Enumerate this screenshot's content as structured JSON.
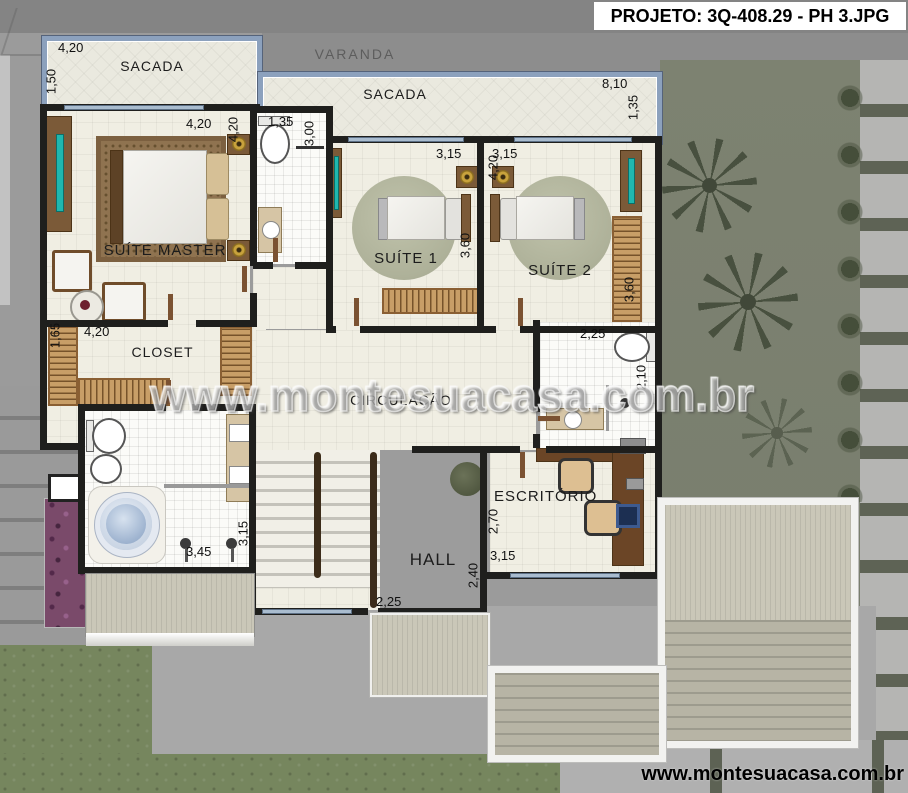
{
  "header": {
    "title": "PROJETO: 3Q-408.29 - PH 3.JPG"
  },
  "watermark": {
    "center": "www.montesuacasa.com.br",
    "bottom": "www.montesuacasa.com.br"
  },
  "rooms": {
    "sacada_left": {
      "label": "SACADA",
      "dim_w": "4,20",
      "dim_d": "1,50"
    },
    "varanda": {
      "label": "VARANDA"
    },
    "sacada_top": {
      "label": "SACADA",
      "dim_w": "8,10",
      "dim_d": "1,35"
    },
    "suite_master": {
      "label": "SUÍTE MASTER",
      "dim_w": "4,20",
      "dim_d": "4,20"
    },
    "wc_master": {
      "dim_w": "1,35",
      "dim_d": "3,00"
    },
    "suite1": {
      "label": "SUÍTE 1",
      "dim_w": "3,15",
      "dim_d": "3,60"
    },
    "suite2": {
      "label": "SUÍTE 2",
      "dim_w": "3,15",
      "dim_d": "4,20",
      "dim_wardrobe": "3,60"
    },
    "closet": {
      "label": "CLOSET",
      "dim_w": "4,20",
      "dim_d": "1,65"
    },
    "circulacao": {
      "label": "CIRCULAÇÃO"
    },
    "wc_social": {
      "dim_w": "2,25",
      "dim_d": "2,10"
    },
    "escritorio": {
      "label": "ESCRITÓRIO",
      "dim_w": "3,15",
      "dim_d": "2,70"
    },
    "banho_master": {
      "dim_w": "3,45",
      "dim_d": "3,15"
    },
    "hall": {
      "label": "HALL",
      "dim_w": "2,25",
      "dim_d": "2,40"
    }
  },
  "colors": {
    "wall": "#1f1f1d",
    "floor": "#f0eee3",
    "glass_rail": "#8ca1bd",
    "wood": "#7b5a38",
    "wardrobe": "#c89e67",
    "tv_screen": "#1fb7ae",
    "garden": "#7c8170",
    "grass": "#76865e",
    "concrete": "#9b9b9b",
    "roof": "#c6c3b4",
    "flowers": "#7a4a6a",
    "water": "#9fb6d8"
  }
}
